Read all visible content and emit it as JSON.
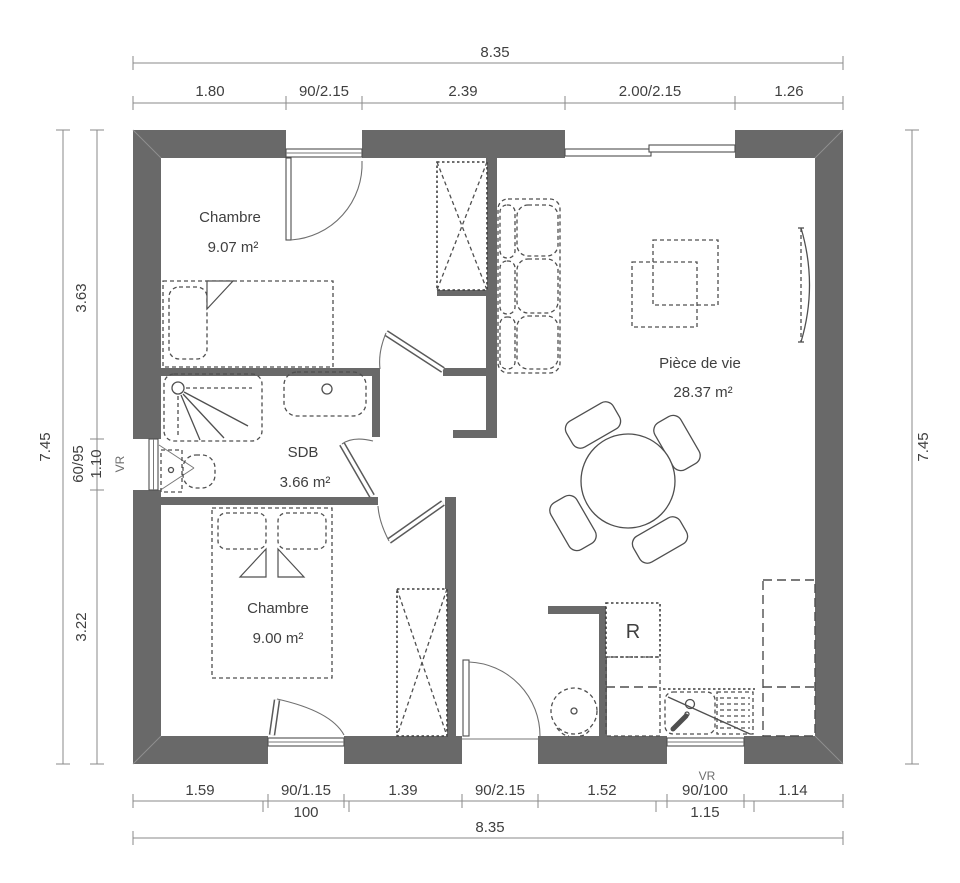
{
  "plan": {
    "rooms": [
      {
        "name": "Chambre",
        "area": "9.07 m²"
      },
      {
        "name": "Pièce de vie",
        "area": "28.37 m²"
      },
      {
        "name": "SDB",
        "area": "3.66 m²"
      },
      {
        "name": "Chambre",
        "area": "9.00 m²"
      }
    ],
    "appliances": {
      "fridge_label": "R"
    },
    "dims": {
      "top_total": "8.35",
      "top_segments": [
        "1.80",
        "90/2.15",
        "2.39",
        "2.00/2.15",
        "1.26"
      ],
      "left_total": "7.45",
      "left_segments": [
        "3.63",
        "60/95",
        "1.10",
        "3.22"
      ],
      "right_total": "7.45",
      "bottom_segments": [
        "1.59",
        "90/1.15",
        "1.39",
        "90/2.15",
        "1.52",
        "90/100",
        "1.14"
      ],
      "bottom_sub_left": "100",
      "bottom_sub_right": "1.15",
      "bottom_total": "8.35",
      "vr_left": "VR",
      "vr_bottom": "VR"
    },
    "colors": {
      "wall": "#696969",
      "furniture_line": "#4f4f4f",
      "dimension_line": "#8a8a8a",
      "text": "#3f3f3f"
    }
  }
}
